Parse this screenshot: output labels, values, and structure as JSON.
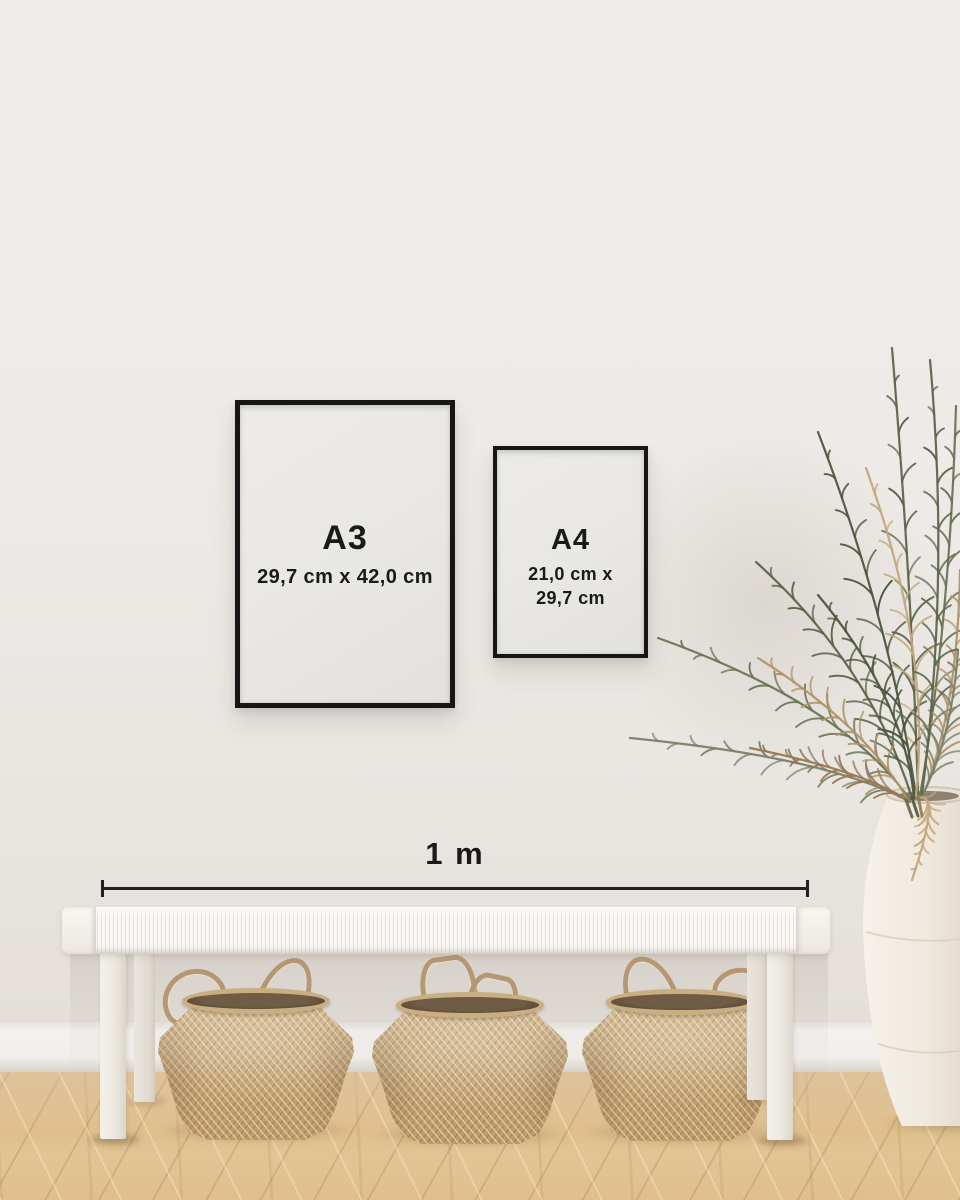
{
  "frames": {
    "a3": {
      "label": "A3",
      "size": "29,7 cm x 42,0 cm"
    },
    "a4": {
      "label": "A4",
      "size_line1": "21,0 cm x",
      "size_line2": "29,7 cm"
    }
  },
  "ruler": {
    "label": "1 m"
  },
  "colors": {
    "wall": "#edeae7",
    "baseboard": "#f3f1ed",
    "floor_wood": "#dcba86",
    "frame_border": "#161616",
    "frame_paper": "#e9e7e4",
    "text": "#1a1a1a",
    "bench_white": "#f4f1ec",
    "basket_tan": "#c9ab7e",
    "basket_interior": "#6e5c44",
    "plant_green": "#5f684c",
    "plant_dried": "#b09365",
    "vase_cream": "#efeadf"
  }
}
